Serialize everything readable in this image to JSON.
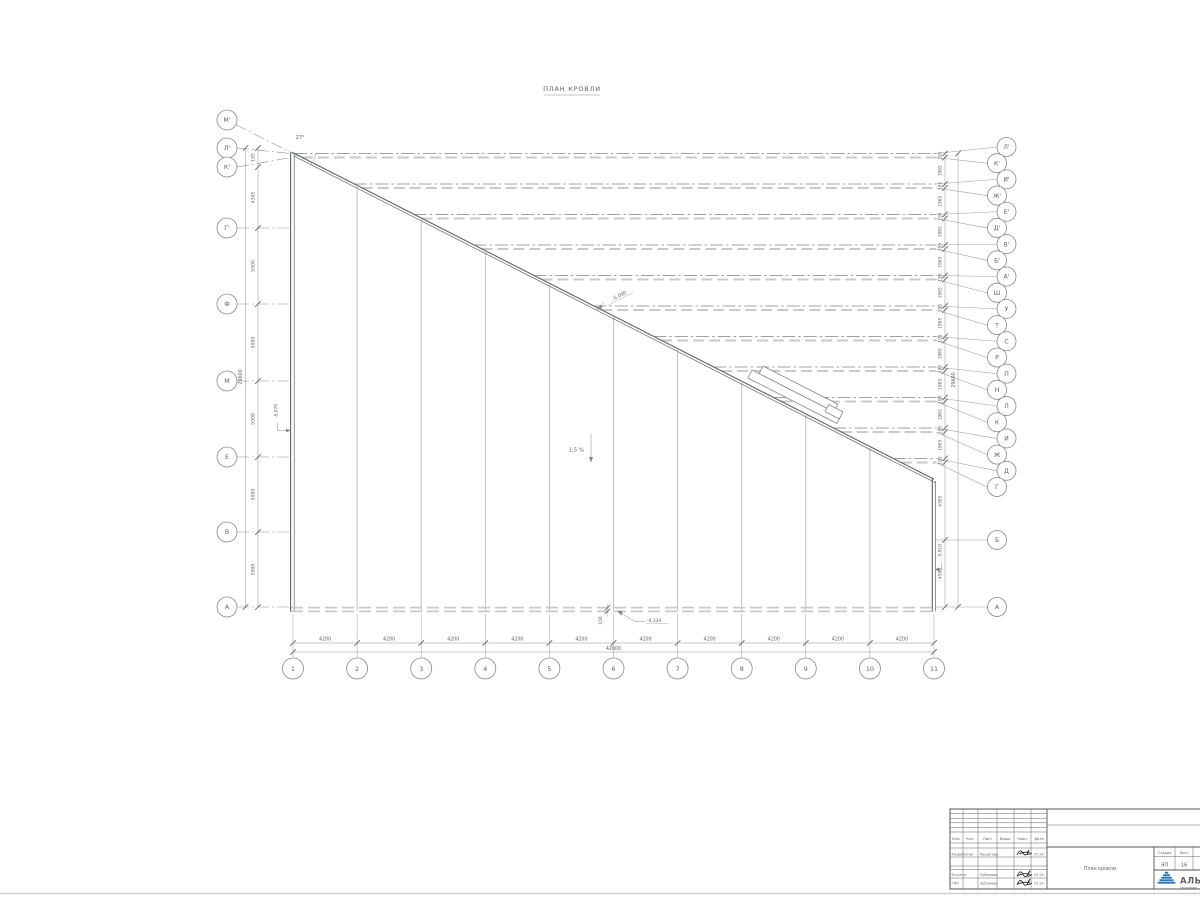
{
  "sheet": {
    "title": "ПЛАН КРОВЛИ"
  },
  "axes": {
    "left": [
      "М'",
      "Л'",
      "К'",
      "Г'",
      "Ф",
      "М",
      "Е",
      "В",
      "А"
    ],
    "right": [
      "Л'",
      "К'",
      "И'",
      "Ж'",
      "Е'",
      "Д'",
      "В'",
      "Б'",
      "А'",
      "Ш",
      "У",
      "Т",
      "С",
      "Р",
      "П",
      "Н",
      "Л",
      "К",
      "И",
      "Ж",
      "Д",
      "Г",
      "Б",
      "А"
    ],
    "bottom": [
      "1",
      "2",
      "3",
      "4",
      "5",
      "6",
      "7",
      "8",
      "9",
      "10",
      "11"
    ]
  },
  "dimensions": {
    "left_chain": [
      "195",
      "4345",
      "5000",
      "5000",
      "5000",
      "5000",
      "5000"
    ],
    "left_overall": "29600",
    "right_chain": [
      "195",
      "1965",
      "195",
      "1965",
      "195",
      "1965",
      "195",
      "1965",
      "195",
      "1965",
      "195",
      "1965",
      "195",
      "1965",
      "195",
      "1965",
      "195",
      "1965",
      "195",
      "1965",
      "195"
    ],
    "right_lower": [
      "4305",
      "4500"
    ],
    "right_overall": "29600",
    "bottom_chain": [
      "4200",
      "4200",
      "4200",
      "4200",
      "4200",
      "4200",
      "4200",
      "4200",
      "4200",
      "4200"
    ],
    "bottom_overall": "42000"
  },
  "annotations": {
    "angle": "27°",
    "slope": "1,5 %",
    "elev_roof": "-5,090",
    "elev_left": "-5,070",
    "elev_right": "-5,910",
    "elev_bottom": "-4,334",
    "dim_100": "100"
  },
  "titleblock": {
    "header_cols": [
      "Изм.",
      "Кол.",
      "Лист",
      "№док.",
      "Подп.",
      "Дата"
    ],
    "rows": [
      {
        "role": "Разработал",
        "name": "Решетова",
        "date": "07.24"
      },
      {
        "role": "Н.контр",
        "name": "Зубанова",
        "date": "07.24"
      },
      {
        "role": "ГАП",
        "name": "Зубанова",
        "date": "07.24"
      }
    ],
    "stage_label": "Стадия",
    "sheet_label": "Лист",
    "stage": "ЭП",
    "sheet_no": "16",
    "drawing_name": "План кровли",
    "logo_text": "АЛЬЯ",
    "logo_sub": "строительн",
    "logo_color": "#2e77b8"
  }
}
